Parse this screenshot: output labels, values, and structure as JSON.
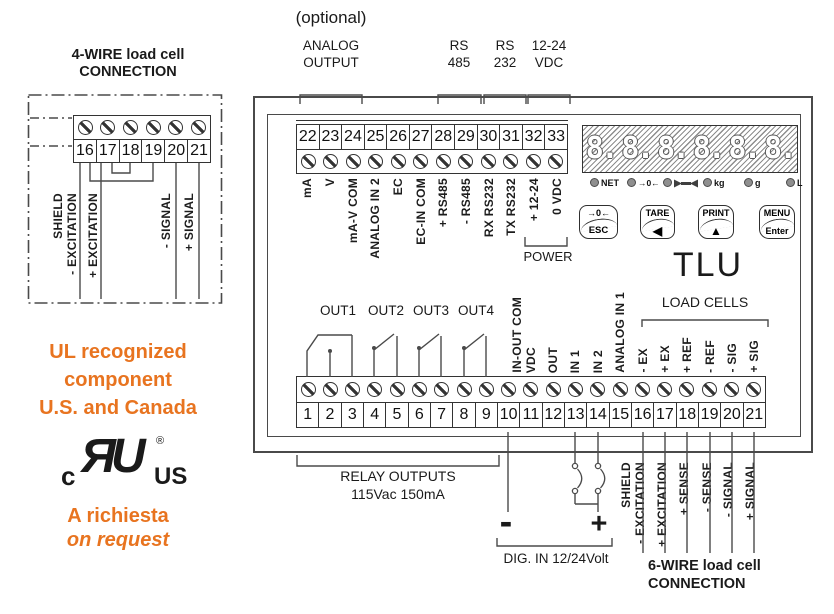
{
  "colors": {
    "accent_orange": "#e87420",
    "line": "#4a4a4a"
  },
  "left_panel": {
    "four_wire_title_1": "4-WIRE load cell",
    "four_wire_title_2": "CONNECTION",
    "terminals": [
      "16",
      "17",
      "18",
      "19",
      "20",
      "21"
    ],
    "wire_labels": [
      "SHIELD",
      "- EXCITATION",
      "+ EXCITATION",
      "- SIGNAL",
      "+ SIGNAL"
    ],
    "ul_line_1": "UL recognized",
    "ul_line_2": "component",
    "ul_line_3": "U.S. and Canada",
    "ul_logo_c": "c",
    "ul_logo_mark": "ЯU",
    "ul_logo_reg": "®",
    "ul_logo_us": "US",
    "request_line_it": "A richiesta",
    "request_line_en": "on request"
  },
  "top_annotations": {
    "optional": "(optional)",
    "analog_output_1": "ANALOG",
    "analog_output_2": "OUTPUT",
    "rs485_1": "RS",
    "rs485_2": "485",
    "rs232_1": "RS",
    "rs232_2": "232",
    "vdc_1": "12-24",
    "vdc_2": "VDC"
  },
  "unit": {
    "model": "TLU",
    "top_strip": {
      "numbers": [
        "22",
        "23",
        "24",
        "25",
        "26",
        "27",
        "28",
        "29",
        "30",
        "31",
        "32",
        "33"
      ],
      "labels": [
        "mA",
        "V",
        "mA-V COM",
        "ANALOG IN 2",
        "EC",
        "EC-IN COM",
        "+ RS485",
        "- RS485",
        "RX RS232",
        "TX RS232",
        "+ 12-24",
        "0 VDC"
      ]
    },
    "power_label": "POWER",
    "display": {
      "digits": [
        "8.",
        "8.",
        "8.",
        "8.",
        "8.",
        "8."
      ],
      "leds": [
        {
          "label": "NET"
        },
        {
          "label": "→0←"
        },
        {
          "label": "",
          "icon": "stability-icon"
        },
        {
          "label": "kg"
        },
        {
          "label": "g"
        },
        {
          "label": "L"
        }
      ]
    },
    "keys": [
      {
        "top": "→0←",
        "bottom": "ESC"
      },
      {
        "top": "TARE",
        "bottom": "◀"
      },
      {
        "top": "PRINT",
        "bottom": "▲"
      },
      {
        "top": "MENU",
        "bottom": "Enter"
      }
    ],
    "load_cells_label": "LOAD CELLS",
    "bottom_strip": {
      "numbers": [
        "1",
        "2",
        "3",
        "4",
        "5",
        "6",
        "7",
        "8",
        "9",
        "10",
        "11",
        "12",
        "13",
        "14",
        "15",
        "16",
        "17",
        "18",
        "19",
        "20",
        "21"
      ],
      "out_labels": [
        "OUT1",
        "OUT2",
        "OUT3",
        "OUT4"
      ],
      "mid_labels": [
        "IN-OUT COM",
        "VDC",
        "OUT",
        "IN 1",
        "IN 2",
        "ANALOG IN 1"
      ],
      "load_cell_labels": [
        "- EX",
        "+ EX",
        "+ REF",
        "- REF",
        "- SIG",
        "+ SIG"
      ]
    }
  },
  "bottom_annotations": {
    "relay_line_1": "RELAY OUTPUTS",
    "relay_line_2": "115Vac 150mA",
    "minus": "-",
    "plus": "+",
    "dig_in": "DIG. IN 12/24Volt",
    "six_wire_labels": [
      "SHIELD",
      "- EXCITATION",
      "+ EXCITATION",
      "+ SENSE",
      "- SENSE",
      "- SIGNAL",
      "+ SIGNAL"
    ],
    "six_wire_title_1": "6-WIRE load cell",
    "six_wire_title_2": "CONNECTION"
  }
}
